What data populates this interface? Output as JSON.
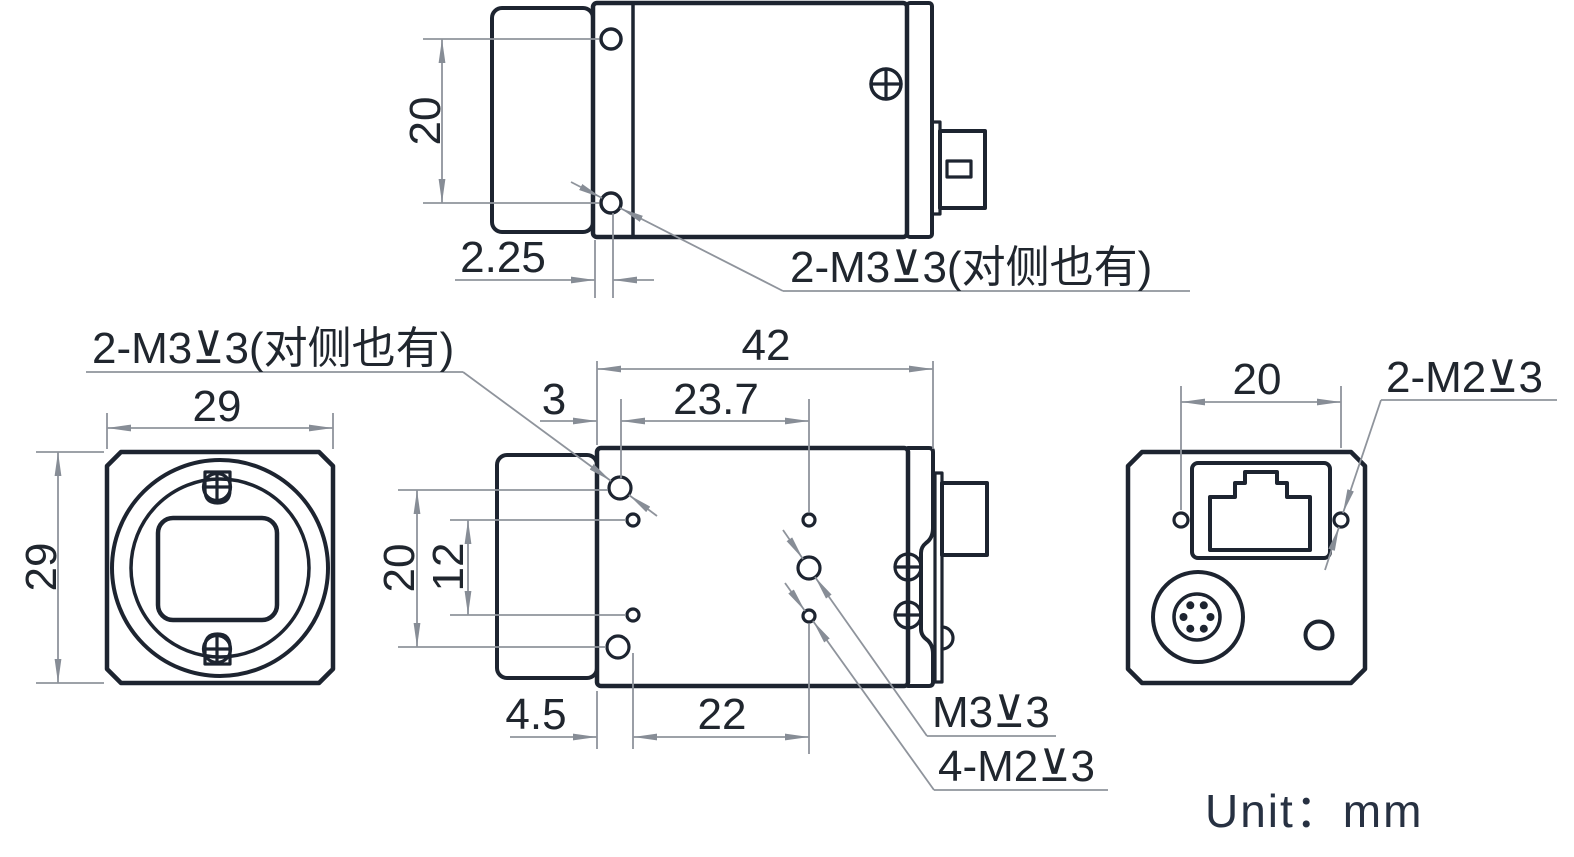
{
  "unit_label": "Unit：mm",
  "colors": {
    "line": "#1d2430",
    "dimension": "#8f949c",
    "text": "#20262e"
  },
  "top_view": {
    "dim_hole_pitch": "20",
    "dim_hole_offset": "2.25",
    "callout": "2-M3⊻3(对侧也有)"
  },
  "front_view": {
    "dim_width": "29",
    "dim_height": "29"
  },
  "side_view": {
    "dim_length": "42",
    "dim_front_to_m3": "3",
    "dim_m3_span": "23.7",
    "dim_m3_pitch": "20",
    "dim_m2_pitch": "12",
    "dim_front_to_m2": "4.5",
    "dim_m2_span": "22",
    "callout_front_holes": "2-M3⊻3(对侧也有)",
    "callout_m3": "M3⊻3",
    "callout_m2": "4-M2⊻3"
  },
  "rear_view": {
    "dim_hole_pitch": "20",
    "callout": "2-M2⊻3"
  }
}
